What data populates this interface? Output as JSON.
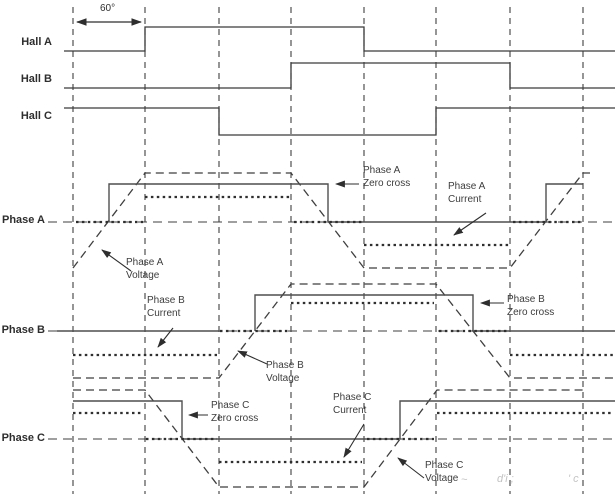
{
  "diagram_title": "BLDC six-step commutation: Hall sensor signals, phase voltages, currents and zero crossings",
  "dim": {
    "angle_label": "60°"
  },
  "labels": {
    "hall_a": "Hall A",
    "hall_b": "Hall B",
    "hall_c": "Hall C",
    "phase_a": "Phase A",
    "phase_b": "Phase B",
    "phase_c": "Phase C"
  },
  "annotations": {
    "phase_a_zero_cross": {
      "line1": "Phase A",
      "line2": "Zero cross"
    },
    "phase_a_current": {
      "line1": "Phase A",
      "line2": "Current"
    },
    "phase_a_voltage": {
      "line1": "Phase A",
      "line2": "Voltage"
    },
    "phase_b_current": {
      "line1": "Phase B",
      "line2": "Current"
    },
    "phase_b_voltage": {
      "line1": "Phase B",
      "line2": "Voltage"
    },
    "phase_b_zero_cross": {
      "line1": "Phase B",
      "line2": "Zero cross"
    },
    "phase_c_zero_cross": {
      "line1": "Phase C",
      "line2": "Zero cross"
    },
    "phase_c_current": {
      "line1": "Phase C",
      "line2": "Current"
    },
    "phase_c_voltage": {
      "line1": "Phase C",
      "line2": "Voltage"
    }
  },
  "watermark": {
    "t1": "~",
    "t2": "d'i ;",
    "t3": "' c"
  },
  "signals": {
    "x_unit": "electrical degrees",
    "division_deg": 60,
    "visible_span_deg": 447,
    "hall_a": {
      "type": "digital",
      "segments": [
        [
          0,
          60,
          "low"
        ],
        [
          60,
          240,
          "high"
        ],
        [
          240,
          447,
          "low"
        ]
      ]
    },
    "hall_b": {
      "type": "digital",
      "segments": [
        [
          0,
          180,
          "low"
        ],
        [
          180,
          360,
          "high"
        ],
        [
          360,
          447,
          "low"
        ]
      ]
    },
    "hall_c": {
      "type": "digital",
      "segments": [
        [
          0,
          120,
          "high"
        ],
        [
          120,
          300,
          "low"
        ],
        [
          300,
          447,
          "high"
        ]
      ]
    },
    "phase_a": {
      "voltage_trapezoid_deg": {
        "ramp_up": [
          [
            0,
            60
          ],
          [
            360,
            420
          ]
        ],
        "top": [
          [
            60,
            180
          ],
          [
            420,
            447
          ]
        ],
        "ramp_down": [
          [
            180,
            240
          ]
        ],
        "bottom": [
          [
            240,
            360
          ]
        ]
      },
      "zero_crossings_deg": [
        30,
        210,
        390
      ],
      "current_deg": {
        "positive": [
          [
            60,
            180
          ]
        ],
        "zero": [
          [
            0,
            60
          ],
          [
            180,
            240
          ],
          [
            360,
            420
          ]
        ],
        "negative": [
          [
            240,
            360
          ]
        ]
      }
    },
    "phase_b": {
      "voltage_trapezoid_deg": {
        "bottom": [
          [
            0,
            120
          ],
          [
            360,
            447
          ]
        ],
        "ramp_up": [
          [
            120,
            180
          ]
        ],
        "top": [
          [
            180,
            300
          ]
        ],
        "ramp_down": [
          [
            300,
            360
          ]
        ]
      },
      "zero_crossings_deg": [
        150,
        330
      ],
      "current_deg": {
        "negative": [
          [
            0,
            120
          ],
          [
            360,
            447
          ]
        ],
        "zero": [
          [
            120,
            180
          ],
          [
            300,
            360
          ]
        ],
        "positive": [
          [
            180,
            300
          ]
        ]
      }
    },
    "phase_c": {
      "voltage_trapezoid_deg": {
        "top": [
          [
            0,
            60
          ],
          [
            300,
            420
          ]
        ],
        "ramp_down": [
          [
            60,
            120
          ]
        ],
        "bottom": [
          [
            120,
            240
          ]
        ],
        "ramp_up": [
          [
            240,
            300
          ]
        ]
      },
      "zero_crossings_deg": [
        90,
        270
      ],
      "current_deg": {
        "positive": [
          [
            0,
            60
          ],
          [
            300,
            420
          ]
        ],
        "zero": [
          [
            60,
            120
          ],
          [
            240,
            300
          ]
        ],
        "negative": [
          [
            120,
            240
          ]
        ]
      }
    }
  }
}
